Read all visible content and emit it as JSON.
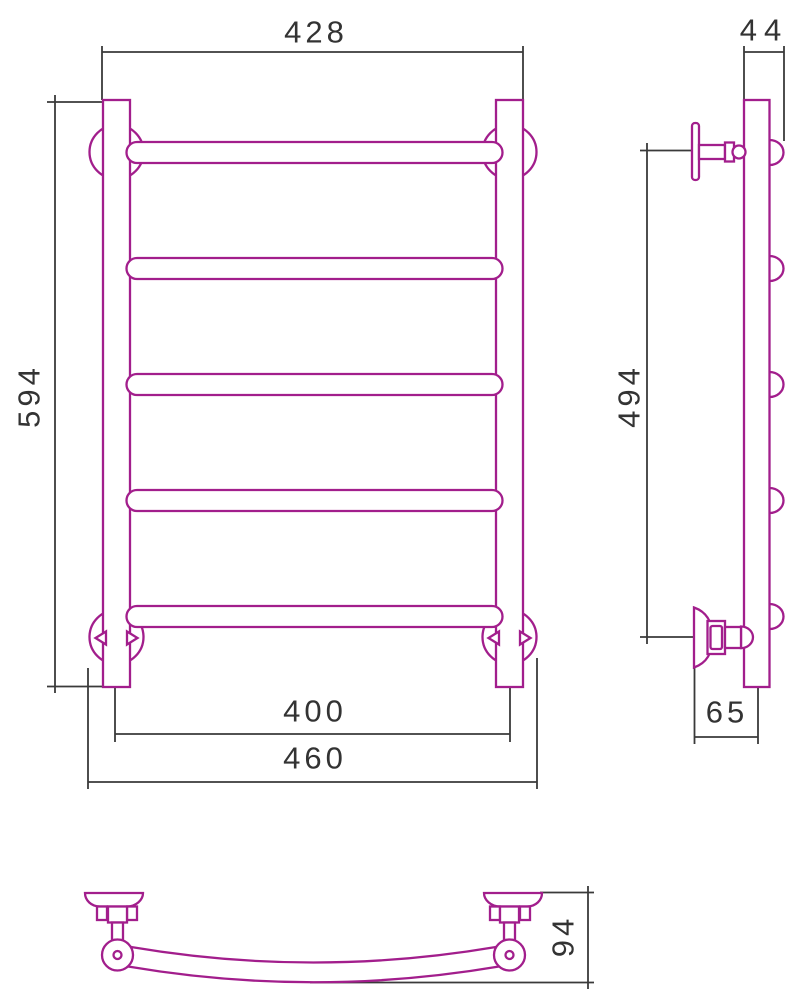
{
  "drawing": {
    "background": "#ffffff",
    "product_line_color": "#A21E8C",
    "dimension_line_color": "#3a3a3a",
    "views": {
      "front": {
        "name": "front-view",
        "rails_count": 5,
        "dimensions": {
          "overall_width": "428",
          "overall_height": "594",
          "axis_spacing_width": "400",
          "bracket_outer_width": "460"
        }
      },
      "side": {
        "name": "side-view",
        "dimensions": {
          "top_depth": "44",
          "bracket_axis_height": "494",
          "wall_to_axis_depth": "65"
        }
      },
      "top": {
        "name": "top-view",
        "dimensions": {
          "wall_to_front_depth": "94"
        }
      }
    }
  }
}
